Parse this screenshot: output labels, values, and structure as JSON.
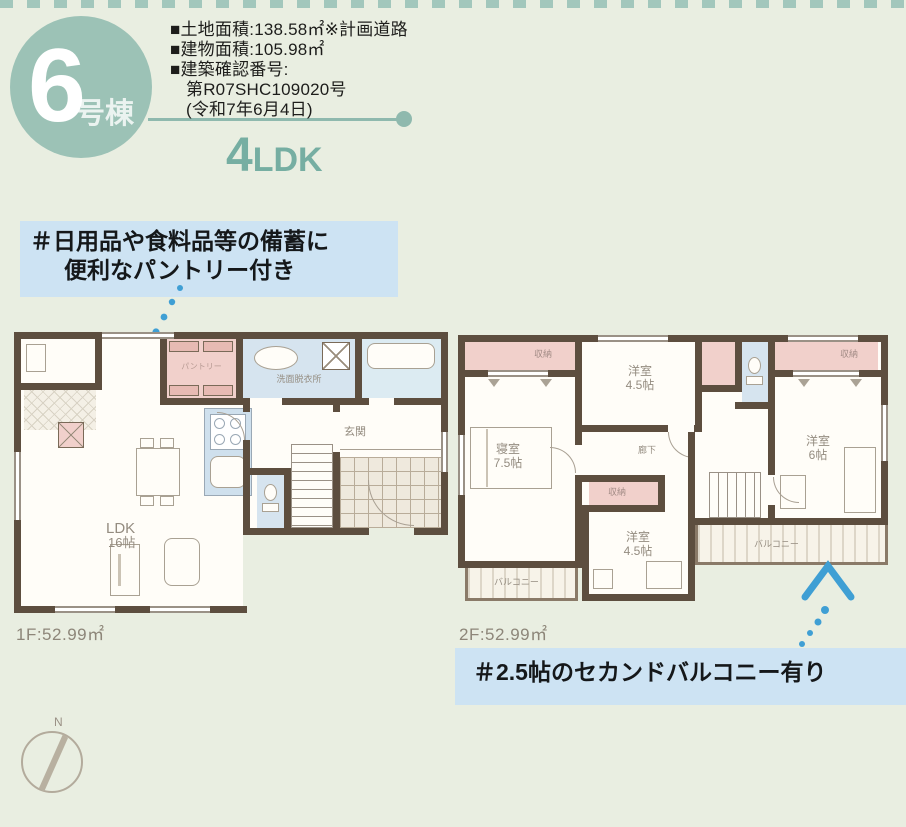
{
  "colors": {
    "accent_teal": "#8fb9ae",
    "circle_teal": "#9cc2b6",
    "arrow_blue": "#3f9fd4",
    "wall_brown": "#5d4e3f",
    "room_pink": "#f1d0cb",
    "room_blue": "#d6e4ef",
    "annotation_bg": "#cde3f3",
    "page_bg": "#e9eee1"
  },
  "header": {
    "unit_number": "6",
    "unit_suffix": "号棟",
    "specs": [
      "■土地面積:138.58㎡※計画道路",
      "■建物面積:105.98㎡",
      "■建築確認番号:",
      "第R07SHC109020号",
      "(令和7年6月4日)"
    ],
    "layout_number": "4",
    "layout_suffix": "LDK"
  },
  "annotations": {
    "pantry_line1": "＃日用品や食料品等の備蓄に",
    "pantry_line2": "便利なパントリー付き",
    "balcony_text": "＃2.5帖のセカンドバルコニー有り"
  },
  "floor1": {
    "area_label": "1F:52.99㎡",
    "ldk": "LDK",
    "ldk_size": "16帖",
    "pantry": "パントリー",
    "washroom": "洗面脱衣所",
    "entrance": "玄関"
  },
  "floor2": {
    "area_label": "2F:52.99㎡",
    "bedroom": "寝室",
    "bedroom_size": "7.5帖",
    "west_room_a": "洋室",
    "west_room_a_size": "4.5帖",
    "west_room_b": "洋室",
    "west_room_b_size": "6帖",
    "west_room_c": "洋室",
    "west_room_c_size": "4.5帖",
    "closet": "収納",
    "hallway": "廊下",
    "balcony": "バルコニー"
  },
  "compass": {
    "north": "N"
  }
}
